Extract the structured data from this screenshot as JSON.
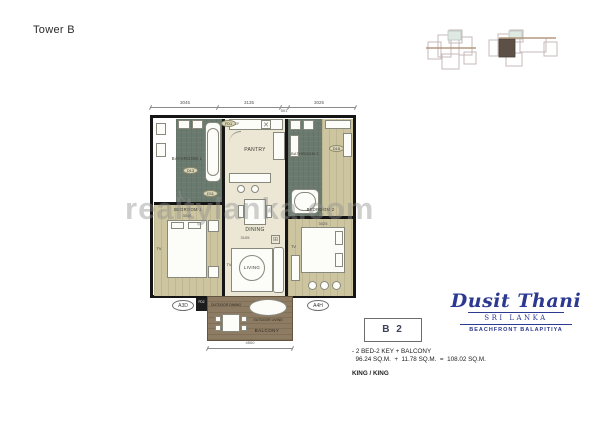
{
  "page": {
    "title": "Tower B"
  },
  "watermark": "realtylanka.com",
  "plan": {
    "dim_top": [
      "3045",
      "3135",
      "3025"
    ],
    "dim_top_small": "501",
    "dim_bottom": "4500",
    "rooms": {
      "bathroom1": "BATHROOM 1",
      "bathroom2": "BATHROOM 2",
      "pantry": "PANTRY",
      "dining": "DINING",
      "living": "LIVING",
      "bedroom1": "BEDROOM 1",
      "bedroom2": "BEDROOM 2",
      "balcony": "BALCONY",
      "outdoor_dining": "OUTDOOR DINING",
      "outdoor_living": "OUTDOOR LIVING"
    },
    "labels": {
      "fd1": "FD1",
      "fd2": "FD2",
      "d13": "D13",
      "d11": "D11",
      "d15": "D15",
      "a3d": "A3D",
      "a4h": "A4H",
      "tv": "TV",
      "ref": "REF",
      "bed1_dim": "3045",
      "bed2_dim": "3025",
      "living_dim": "3105"
    }
  },
  "brand": {
    "name": "Dusit Thani",
    "location": "SRI LANKA",
    "tagline": "BEACHFRONT BALAPITIYA",
    "color": "#2b3990"
  },
  "unit": {
    "code": "B 2",
    "description": "- 2 BED-2 KEY + BALCONY",
    "area_line": "  96.24 SQ.M.  +  11.78 SQ.M.  =  108.02 SQ.M.",
    "bed_config": "KING / KING"
  }
}
